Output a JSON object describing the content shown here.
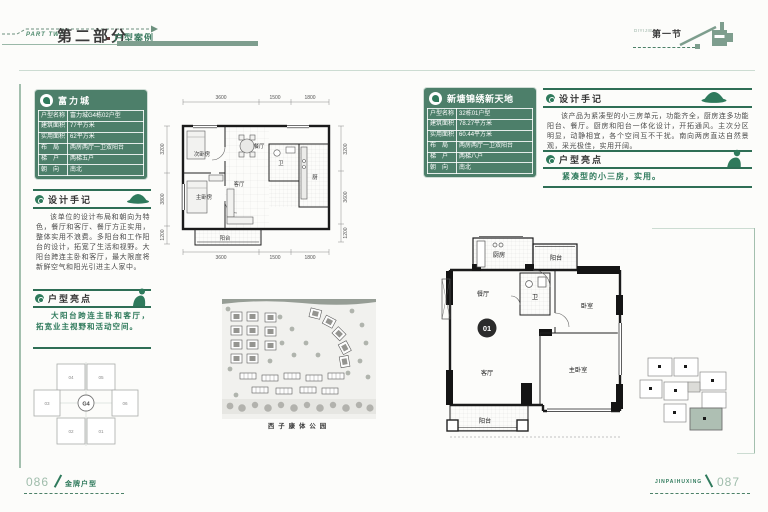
{
  "header": {
    "part_en": "PART TWO",
    "part_cn": "第二部分",
    "part_sub": "户型案例",
    "section_sub": "DIYIJIE",
    "section_cn": "第一节"
  },
  "left_page": {
    "project_name": "富力城",
    "info_rows": [
      {
        "label": "户型名称",
        "value": "富力城G4栋02户型"
      },
      {
        "label": "建筑面积",
        "value": "77平方米"
      },
      {
        "label": "实用面积",
        "value": "62平方米"
      },
      {
        "label": "布　局",
        "value": "两房两厅一卫双阳台"
      },
      {
        "label": "梯　户",
        "value": "两梯五户"
      },
      {
        "label": "朝　向",
        "value": "南北"
      }
    ],
    "notes_title": "设计手记",
    "notes_body": "该单位的设计布局和朝向为特色，餐厅和客厅、餐厅方正实用，整体实用不浪费。多阳台和工作阳台的设计，拓宽了生活和视野。大阳台跨连主卧和客厅，最大限度将新鲜空气和阳光引进主人家中。",
    "highlight_title": "户型亮点",
    "highlight_body": "大阳台跨连主卧和客厅，拓宽业主视野和活动空间。",
    "floorplan": {
      "dims_top": [
        "3600",
        "1500",
        "1800"
      ],
      "dims_bottom": [
        "3600",
        "1500",
        "1800"
      ],
      "dims_left": [
        "3200",
        "3800",
        "1200"
      ],
      "dims_right": [
        "3200",
        "3600",
        "1200"
      ],
      "rooms": {
        "bed2": "次卧房",
        "bed1": "主卧房",
        "dining": "餐厅",
        "living": "客厅",
        "bath": "卫",
        "kitchen": "厨",
        "balcony": "阳台"
      }
    },
    "siteplan_caption": "西子康体公园",
    "keyplan": {
      "core": "G4",
      "units": [
        "04",
        "05",
        "03",
        "06",
        "02",
        "01"
      ]
    },
    "page_no": "086",
    "footer_label": "金牌户型"
  },
  "right_page": {
    "project_name": "新塘锦绣新天地",
    "info_rows": [
      {
        "label": "户型名称",
        "value": "32栋01户型"
      },
      {
        "label": "建筑面积",
        "value": "78.27平方米"
      },
      {
        "label": "实用面积",
        "value": "60.44平方米"
      },
      {
        "label": "布　局",
        "value": "两房两厅一卫双阳台"
      },
      {
        "label": "梯　户",
        "value": "两梯八户"
      },
      {
        "label": "朝　向",
        "value": "南北"
      }
    ],
    "notes_title": "设计手记",
    "notes_body": "该产品为紧凑型的小三房单元，功能齐全，厨房连多功能阳台、餐厅。厨房和阳台一体化设计，开拓通风。主次分区明显，动静相宜，各个空间互不干扰。南向两房直达自然景观，采光极佳，实用开阔。",
    "highlight_title": "户型亮点",
    "highlight_body": "紧凑型的小三房，实用。",
    "floorplan": {
      "unit_no": "01",
      "rooms": {
        "kitchen": "厨房",
        "balcony_top": "阳台",
        "dining": "餐厅",
        "bath": "卫",
        "bed2": "卧室",
        "living": "客厅",
        "bed1": "主卧室",
        "balcony_bottom": "阳台"
      }
    },
    "page_no": "087",
    "footer_label": "JINPAIHUXING"
  },
  "colors": {
    "accent": "#2f7a5c",
    "sage": "#7e9e8e",
    "box_green": "#4d7f6a"
  }
}
